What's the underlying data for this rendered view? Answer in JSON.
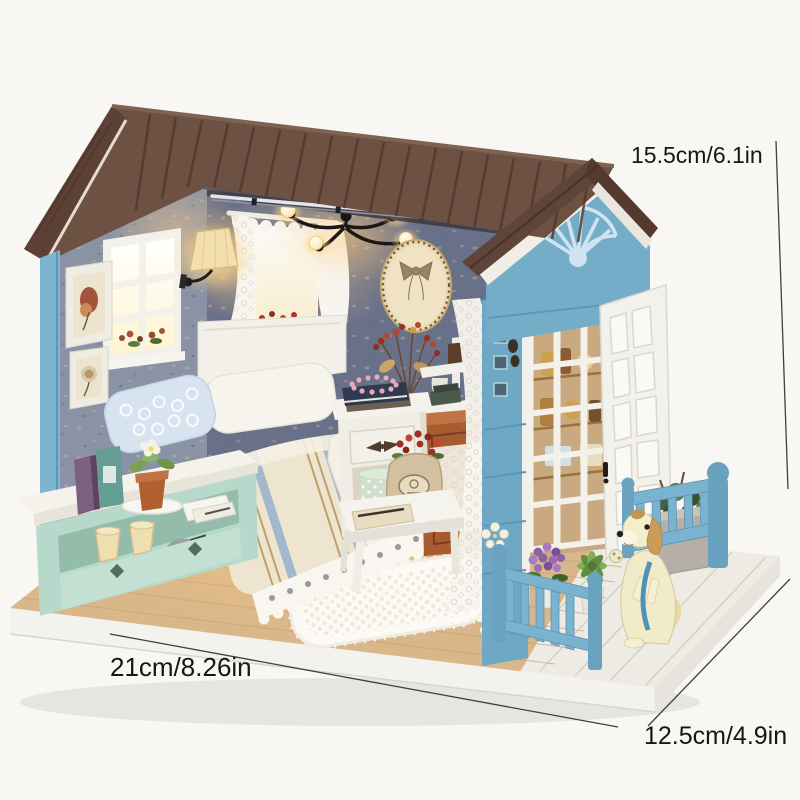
{
  "subject": "DIY miniature dollhouse kit product photo with size annotations",
  "annotations": {
    "height_label": "15.5cm/6.1in",
    "width_label": "21cm/8.26in",
    "depth_label": "12.5cm/4.9in"
  },
  "palette": {
    "background": "#f8f7f4",
    "roof_brown": "#6d5143",
    "roof_groove": "#53382d",
    "gable_blue": "#74adc8",
    "porch_blue": "#7ab3cf",
    "wall_gray_blue": "#7f8699",
    "back_wall": "#68708a",
    "wood_floor": "#d9b78a",
    "deck_white": "#edebe4",
    "bench_mint": "#b7d9cb",
    "cabinet_orange": "#a75b31",
    "lace_white": "#f7f5ee",
    "dog_cream": "#f2ebc9",
    "warm_light": "#ffd98e",
    "annotation_text": "#161616"
  },
  "scene": {
    "objects": [
      "gabled plank roof",
      "blue porch gable with sunburst trim",
      "gray-blue speckled walls",
      "six-pane window",
      "two framed pictures",
      "glowing wall lamp",
      "black chandelier with lit bulbs",
      "lace curtain window",
      "oval bow wall plaque",
      "dried berry bouquet",
      "corner wall shelf",
      "bed with striped duvet and lace skirt",
      "lace pillows",
      "white headboard",
      "mint storage bench with books and potted plant",
      "clay pots and trowel",
      "white nightstand with pearl necklace and polka-dot hatboxes",
      "side table with burlap sack of berries",
      "crochet rug",
      "orange cabinet with lace doily",
      "white lattice panel",
      "white trellis door",
      "tall blue corner trellis",
      "blue porch fences",
      "purple hydrangea and succulent pots",
      "gray planter box",
      "cream puppy figurine with blue harness",
      "wooden display base with white rim"
    ]
  }
}
